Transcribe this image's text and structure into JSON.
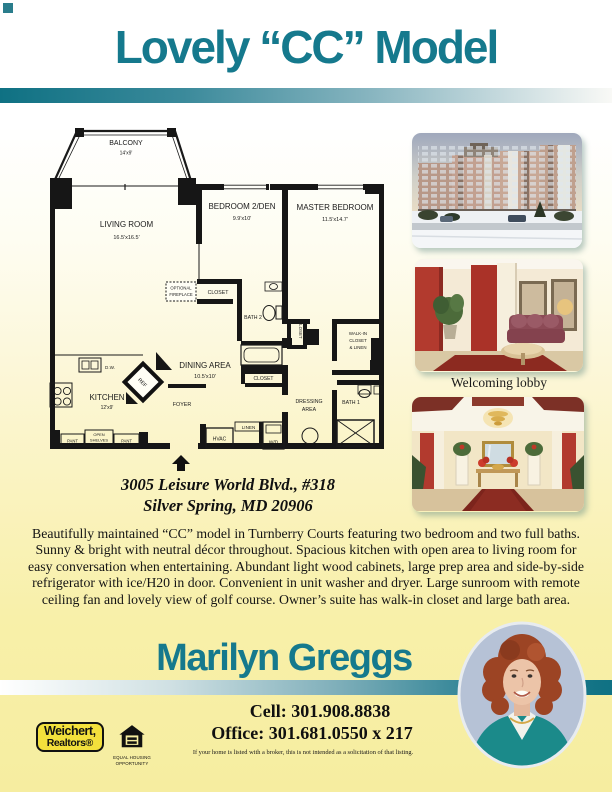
{
  "page": {
    "title": "Lovely “CC” Model",
    "accent_teal": "#15798d",
    "background_yellow": "#f6eda0"
  },
  "floorplan": {
    "balcony_name": "BALCONY",
    "balcony_dims": "14'x9'",
    "living_name": "LIVING ROOM",
    "living_dims": "16.5'x16.5'",
    "bedroom2_name": "BEDROOM 2/DEN",
    "bedroom2_dims": "9.9'x10'",
    "master_name": "MASTER BEDROOM",
    "master_dims": "11.5'x14.7'",
    "dining_name": "DINING AREA",
    "dining_dims": "10.5'x10'",
    "kitchen_name": "KITCHEN",
    "kitchen_dims": "12'x9'",
    "fireplace1": "OPTIONAL",
    "fireplace2": "FIREPLACE",
    "closet": "CLOSET",
    "bath2": "BATH 2",
    "bath1": "BATH 1",
    "walkin1": "WALK-IN",
    "walkin2": "CLOSET",
    "walkin3": "& LINEN",
    "dressing1": "DRESSING",
    "dressing2": "AREA",
    "foyer": "FOYER",
    "dw": "D.W.",
    "ref": "REF",
    "pant": "PANT",
    "shelves1": "OPEN",
    "shelves2": "SHELVES",
    "hvac": "HVAC",
    "linen": "LINEN",
    "wd": "W/D"
  },
  "photos": {
    "lobby_caption": "Welcoming lobby"
  },
  "address": {
    "line1": "3005 Leisure World Blvd., #318",
    "line2": "Silver Spring, MD 20906"
  },
  "description": {
    "lines": [
      "Beautifully maintained “CC” model in Turnberry Courts featuring two bedroom and two full baths.",
      "Sunny & bright with neutral décor throughout. Spacious kitchen with open area to living room for",
      "easy conversation when entertaining. Abundant light wood cabinets, large prep area and side-by-side",
      "refrigerator with ice/H20 in door. Convenient in unit washer and dryer. Large sunroom with remote",
      "ceiling fan and lovely view of golf course. Owner’s suite has walk-in closet and large bath area."
    ]
  },
  "agent": {
    "name": "Marilyn Greggs",
    "cell": "Cell: 301.908.8838",
    "office": "Office: 301.681.0550 x 217",
    "disclaimer": "If your home is listed with a broker, this is not intended as a solicitation of that listing."
  },
  "logos": {
    "weichert_line1": "Weichert,",
    "weichert_line2": "Realtors®",
    "eho_line1": "EQUAL HOUSING",
    "eho_line2": "OPPORTUNITY"
  }
}
